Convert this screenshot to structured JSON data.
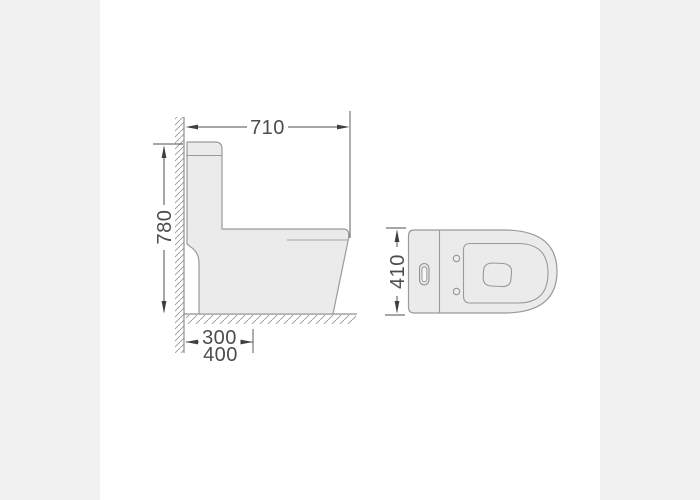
{
  "drawing": {
    "type": "technical-dimension-drawing",
    "subject": "one-piece-toilet",
    "views": [
      {
        "name": "side-view"
      },
      {
        "name": "top-view"
      }
    ],
    "dimensions": {
      "overall_depth": "710",
      "overall_height": "780",
      "rough_in_primary": "300",
      "rough_in_alternate": "400",
      "overall_width": "410"
    },
    "colors": {
      "background": "#ffffff",
      "side_band": "#f1f1f2",
      "body_fill": "#ebebeb",
      "outline": "#9a9a9a",
      "dimension": "#4c4c4c"
    }
  }
}
